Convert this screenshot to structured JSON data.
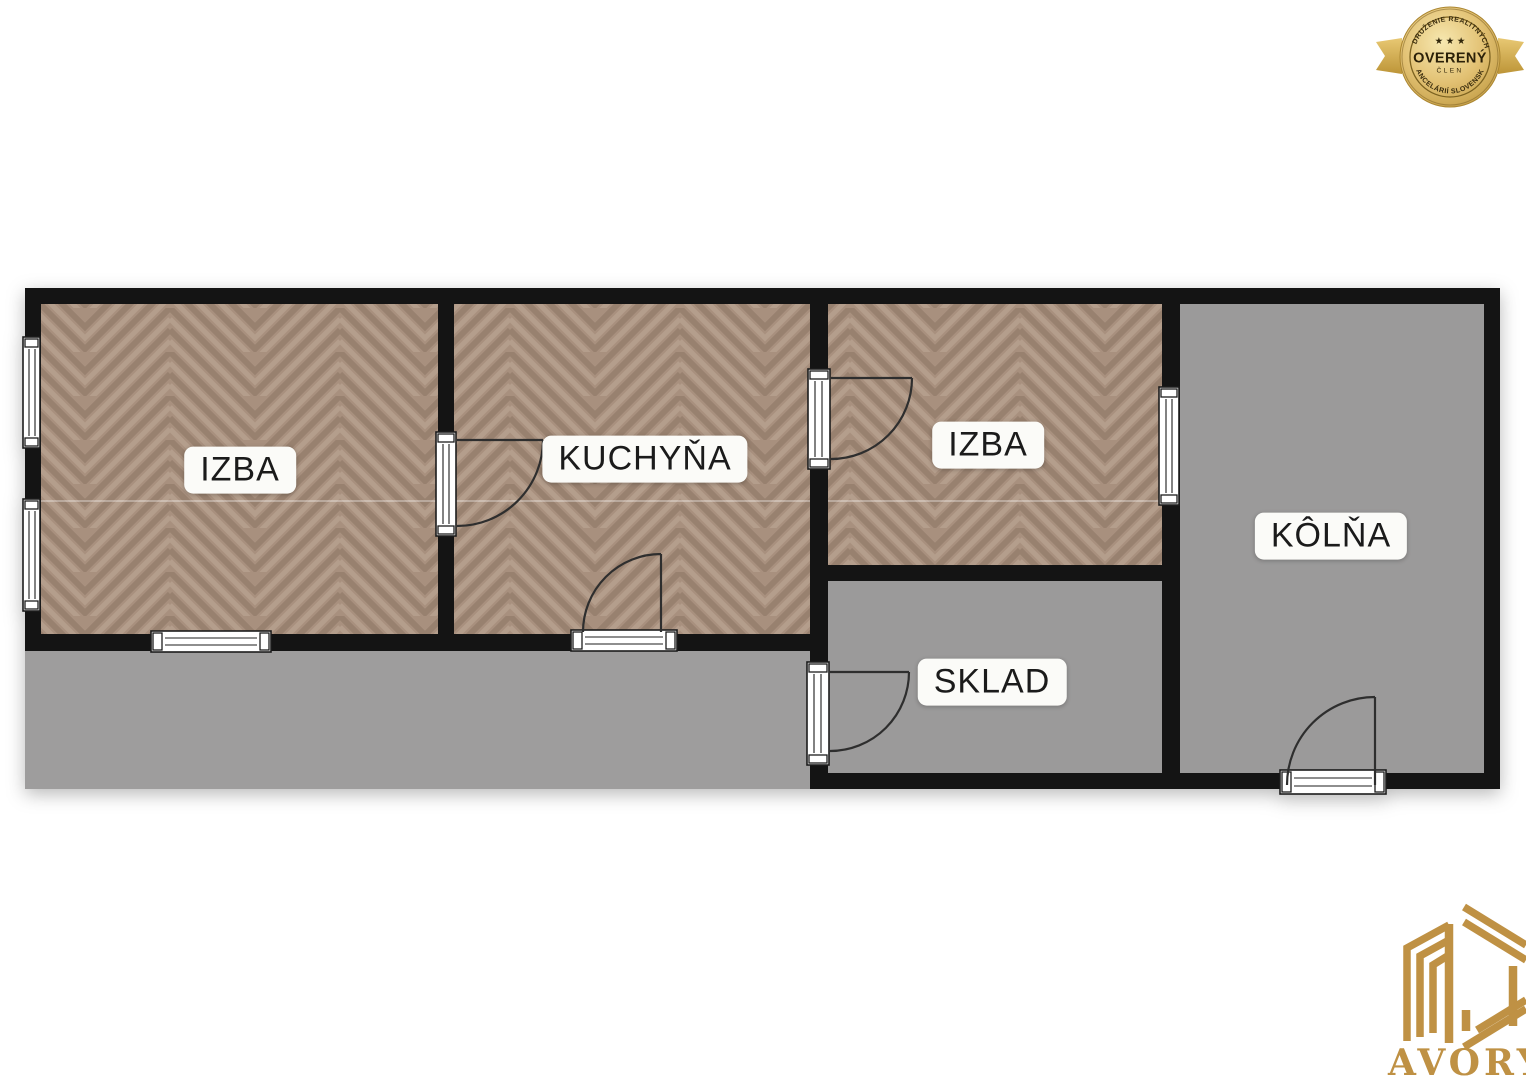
{
  "floorplan": {
    "rooms": [
      {
        "id": "izba-1",
        "label": "IZBA",
        "floor": "parquet"
      },
      {
        "id": "kuchyna",
        "label": "KUCHYŇA",
        "floor": "parquet"
      },
      {
        "id": "izba-2",
        "label": "IZBA",
        "floor": "parquet"
      },
      {
        "id": "kolna",
        "label": "KÔLŇA",
        "floor": "gray"
      },
      {
        "id": "sklad",
        "label": "SKLAD",
        "floor": "gray"
      }
    ]
  },
  "badge": {
    "arc_top": "ZDRUŽENIE REALITNÝCH",
    "stars": "★ ★ ★",
    "title": "OVERENÝ",
    "subtitle": "ČLEN",
    "arc_bottom": "KANCELÁRIÍ SLOVENSKA"
  },
  "logo": {
    "brand": "AVORY"
  },
  "colors": {
    "wall": "#141414",
    "parquet": "#a8907e",
    "floor_gray": "#9b9a9a",
    "outdoor_gray": "#9e9d9d",
    "label_bg": "#fbfbf8",
    "label_text": "#1b1b1b",
    "badge_gold": "#d8b55c",
    "badge_gold_deep": "#b58d33",
    "badge_text": "#392c0e",
    "logo_gold": "#bf9144",
    "door_stroke": "#2e2e2e",
    "frame_stroke": "#1c1c1c"
  }
}
